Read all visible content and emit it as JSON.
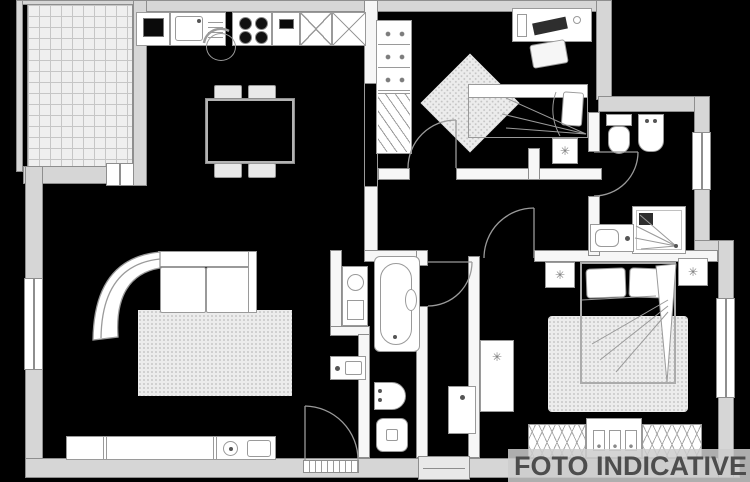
{
  "canvas": {
    "width": 750,
    "height": 482,
    "background": "#000000"
  },
  "watermark": {
    "text": "FOTO INDICATIVE",
    "color": "#4d4d4d",
    "band_color": "#cdcdcd"
  },
  "colors": {
    "exterior_wall": "#d6d6d6",
    "interior_wall": "#f6f6f6",
    "line": "#8e8e8e",
    "furniture_line": "#9a9a9a",
    "tile": "#efefef",
    "tile_line": "#c6c6c6",
    "rug": "#ececec",
    "rug_dot": "#c2c2c2"
  },
  "glyphs": {
    "flower": "✳"
  },
  "plan": {
    "type": "floor-plan",
    "areas": [
      "balcony",
      "kitchen-dining",
      "living-room",
      "bedroom-1",
      "bathroom-1",
      "hallway",
      "bathroom-2",
      "master-bedroom"
    ],
    "fixtures": [
      "kitchen-counter",
      "sink",
      "stove",
      "dining-table",
      "corner-sofa",
      "tv-cabinet",
      "bathtub",
      "bidet",
      "toilet",
      "washbasin",
      "shower",
      "single-bed",
      "double-bed",
      "wardrobe",
      "desk",
      "nightstand",
      "rug"
    ]
  }
}
